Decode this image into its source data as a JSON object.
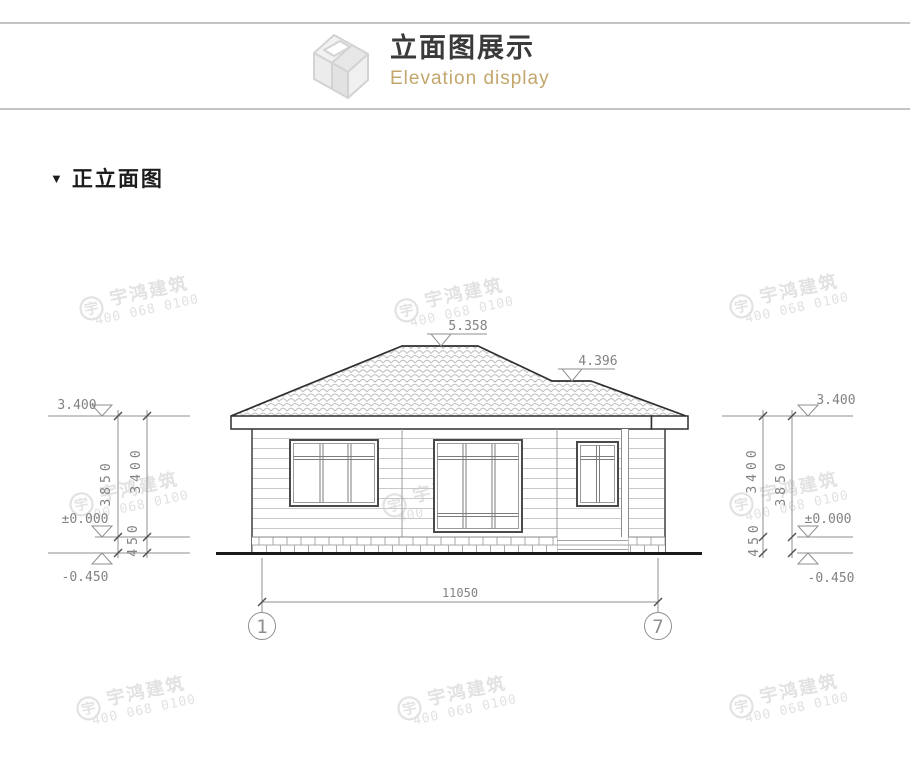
{
  "header": {
    "title": "立面图展示",
    "subtitle": "Elevation display",
    "icon": "isometric-box-icon"
  },
  "section": {
    "marker": "▼",
    "title": "正立面图"
  },
  "watermark": {
    "logo": "宇",
    "brand": "宇鸿建筑",
    "phone": "400 068 0100"
  },
  "drawing": {
    "levels": {
      "ridge": "5.358",
      "step": "4.396",
      "eave": "3.400",
      "floor": "±0.000",
      "ground": "-0.450"
    },
    "vdims": {
      "overall": "3850",
      "wall": "3400",
      "plinth": "450"
    },
    "hdim": {
      "total_width": "11050"
    },
    "axes": {
      "left": "1",
      "right": "7"
    }
  },
  "colors": {
    "accent_gold": "#c2a66b",
    "outline_dark": "#333333",
    "dimension_gray": "#8f8f8f",
    "watermark_gray": "#e2e2e2",
    "divider_gray": "#c3c3c3"
  }
}
